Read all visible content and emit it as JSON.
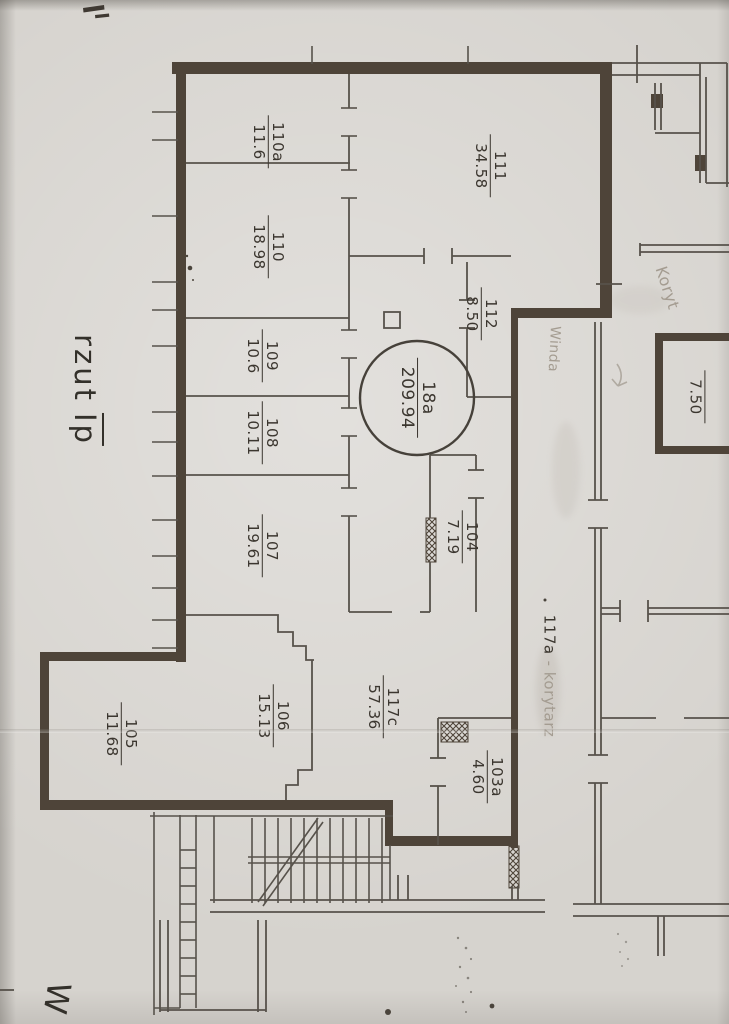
{
  "plan": {
    "title_word": "rzut",
    "title_floor": "Ip",
    "corner_letter": "W"
  },
  "unit": {
    "id": "18a",
    "area": "209.94"
  },
  "rooms": [
    {
      "id": "110a",
      "area": "11.6"
    },
    {
      "id": "110",
      "area": "18.98"
    },
    {
      "id": "111",
      "area": "34.58"
    },
    {
      "id": "112",
      "area": "8.50"
    },
    {
      "id": "109",
      "area": "10.6"
    },
    {
      "id": "108",
      "area": "10.11"
    },
    {
      "id": "107",
      "area": "19.61"
    },
    {
      "id": "104",
      "area": "7.19"
    },
    {
      "id": "106",
      "area": "15.13"
    },
    {
      "id": "117c",
      "area": "57.36"
    },
    {
      "id": "105",
      "area": "11.68"
    },
    {
      "id": "103a",
      "area": "4.60"
    },
    {
      "id": "",
      "area": "7.50"
    }
  ],
  "annotations": {
    "corridor_id": "117a",
    "corridor_note": "- korytarz",
    "pencil_room_note": "Winda",
    "pencil_top_note": "Koryt"
  },
  "colors": {
    "paper": "#d6d3ce",
    "thick_wall": "#4e4439",
    "thin_line": "#57524b",
    "ink": "#3b362f",
    "pencil": "#a49c91"
  }
}
